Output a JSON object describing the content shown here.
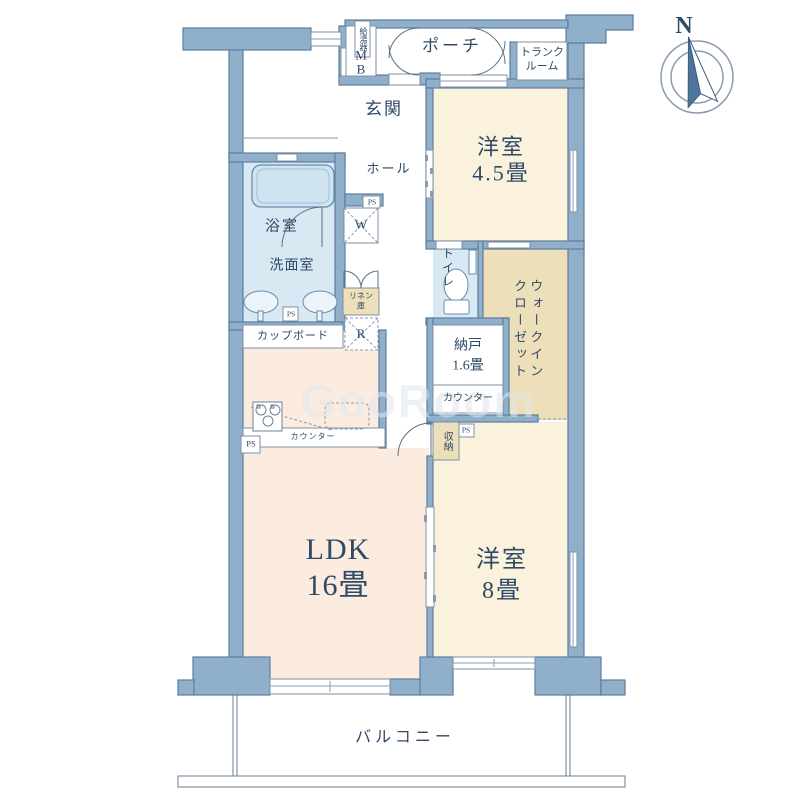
{
  "plan": {
    "compass_north": "N",
    "watermark": "GooRoom",
    "rooms": {
      "ldk": {
        "name": "LDK",
        "size": "16畳"
      },
      "western_8": {
        "name": "洋室",
        "size": "8畳"
      },
      "western_45": {
        "name": "洋室",
        "size": "4.5畳"
      },
      "storeroom": {
        "name": "納戸",
        "size": "1.6畳"
      },
      "wic": {
        "col1": "ウォークイン",
        "col2": "クローゼット"
      },
      "bath": "浴室",
      "washroom": "洗面室",
      "toilet": "トイレ",
      "hall": "ホール",
      "entrance": "玄関",
      "porch": "ポーチ",
      "balcony": "バルコニー",
      "trunk": {
        "line1": "トランク",
        "line2": "ルーム"
      }
    },
    "fixtures": {
      "mb_m": "M",
      "mb_b": "B",
      "water_heater": "給湯器",
      "washer": "W",
      "fridge": "R",
      "ps": "PS",
      "linen1": "リネン",
      "linen2": "庫",
      "cupboard": "カップボード",
      "counter": "カウンター",
      "storage": "収納"
    },
    "colors": {
      "wall": "#8fafcb",
      "wall_stroke": "#5d7d9d",
      "room_cream": "#faf2dc",
      "room_ldk": "#fcece0",
      "room_wet": "#d9e9f4",
      "closet_beige": "#ecdfba",
      "text": "#2e4a66"
    }
  }
}
